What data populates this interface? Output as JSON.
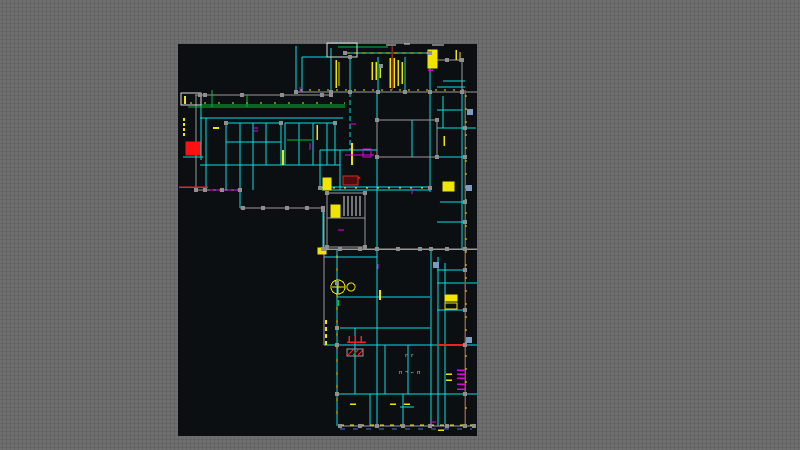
{
  "canvas": {
    "left": 178,
    "top": 44,
    "width": 299,
    "height": 392,
    "background": "#0c0f12"
  },
  "workspace": {
    "background": "#6e6e6e"
  },
  "palette": {
    "c": "#00e0e0",
    "y": "#f0e400",
    "m": "#e000e0",
    "g": "#00bb33",
    "r": "#ee2222",
    "R": "#ff1111",
    "w": "#d8d8d8",
    "gr": "#9a9a9a",
    "br": "#8a5a40",
    "bl": "#4a6cdc",
    "mr": "#802828",
    "hr": "#4a0e0e",
    "sq": "#8f8f8f",
    "bs": "#7e9cc2"
  },
  "drawing": {
    "lines": [
      [
        "c",
        345,
        53,
        430,
        53
      ],
      [
        "c",
        331,
        48,
        331,
        92
      ],
      [
        "c",
        296,
        46,
        296,
        92
      ],
      [
        "c",
        302,
        57,
        302,
        92
      ],
      [
        "c",
        302,
        57,
        331,
        57
      ],
      [
        "c",
        350,
        57,
        350,
        92
      ],
      [
        "c",
        378,
        57,
        378,
        92
      ],
      [
        "c",
        405,
        57,
        405,
        92
      ],
      [
        "c",
        430,
        53,
        430,
        92
      ],
      [
        "c",
        443,
        81,
        465,
        81
      ],
      [
        "c",
        437,
        87,
        465,
        87
      ],
      [
        "c",
        437,
        110,
        462,
        110
      ],
      [
        "c",
        443,
        96,
        443,
        128
      ],
      [
        "c",
        437,
        128,
        476,
        128
      ],
      [
        "c",
        377,
        157,
        465,
        157
      ],
      [
        "c",
        462,
        92,
        462,
        250
      ],
      [
        "c",
        377,
        92,
        377,
        250
      ],
      [
        "c",
        430,
        92,
        430,
        192
      ],
      [
        "c",
        412,
        120,
        412,
        157
      ],
      [
        "c",
        440,
        202,
        465,
        202
      ],
      [
        "c",
        437,
        222,
        465,
        222
      ],
      [
        "c",
        320,
        187,
        430,
        187
      ],
      [
        "c",
        322,
        190,
        430,
        190
      ],
      [
        "c",
        320,
        150,
        320,
        190
      ],
      [
        "c",
        320,
        150,
        377,
        150
      ],
      [
        "c",
        340,
        150,
        340,
        190
      ],
      [
        "c",
        350,
        92,
        350,
        150,
        1,
        "5 3"
      ],
      [
        "c",
        201,
        95,
        201,
        160
      ],
      [
        "c",
        200,
        118,
        343,
        118
      ],
      [
        "c",
        240,
        123,
        240,
        165
      ],
      [
        "c",
        253,
        123,
        253,
        165
      ],
      [
        "c",
        266,
        123,
        266,
        165
      ],
      [
        "c",
        226,
        142,
        281,
        142
      ],
      [
        "c",
        299,
        123,
        299,
        165
      ],
      [
        "c",
        313,
        123,
        313,
        165
      ],
      [
        "c",
        327,
        123,
        327,
        165
      ],
      [
        "c",
        200,
        165,
        340,
        165
      ],
      [
        "c",
        226,
        165,
        226,
        190
      ],
      [
        "c",
        240,
        165,
        240,
        190
      ],
      [
        "c",
        253,
        165,
        253,
        190
      ],
      [
        "c",
        206,
        118,
        206,
        190
      ],
      [
        "c",
        240,
        190,
        240,
        208
      ],
      [
        "c",
        323,
        210,
        323,
        250
      ],
      [
        "c",
        337,
        250,
        337,
        426
      ],
      [
        "c",
        377,
        250,
        377,
        426
      ],
      [
        "c",
        431,
        249,
        431,
        426
      ],
      [
        "c",
        438,
        257,
        438,
        426
      ],
      [
        "c",
        445,
        263,
        445,
        424
      ],
      [
        "c",
        324,
        257,
        377,
        257
      ],
      [
        "c",
        337,
        297,
        430,
        297
      ],
      [
        "c",
        437,
        270,
        465,
        270
      ],
      [
        "c",
        437,
        283,
        477,
        283
      ],
      [
        "c",
        437,
        310,
        465,
        310
      ],
      [
        "c",
        340,
        328,
        430,
        328
      ],
      [
        "c",
        324,
        345,
        477,
        345
      ],
      [
        "c",
        355,
        328,
        355,
        394
      ],
      [
        "c",
        385,
        345,
        385,
        394
      ],
      [
        "c",
        408,
        345,
        408,
        394
      ],
      [
        "c",
        337,
        394,
        477,
        394
      ],
      [
        "c",
        370,
        394,
        370,
        426
      ],
      [
        "c",
        403,
        394,
        403,
        426
      ],
      [
        "c",
        183,
        157,
        203,
        157
      ],
      [
        "c",
        400,
        407,
        414,
        407
      ],
      [
        "gr",
        296,
        92,
        477,
        92,
        1.2
      ],
      [
        "gr",
        195,
        95,
        331,
        95,
        1.2
      ],
      [
        "gr",
        196,
        95,
        196,
        190
      ],
      [
        "gr",
        195,
        190,
        240,
        190,
        1.2
      ],
      [
        "gr",
        240,
        208,
        323,
        208,
        1.2
      ],
      [
        "gr",
        324,
        210,
        324,
        345
      ],
      [
        "gr",
        324,
        249,
        477,
        249,
        1.5
      ],
      [
        "gr",
        340,
        426,
        475,
        426,
        1.2
      ],
      [
        "gr",
        327,
        218,
        365,
        218
      ],
      [
        "gr",
        437,
        60,
        462,
        60
      ],
      [
        "gr",
        462,
        60,
        462,
        92
      ],
      [
        "br",
        465,
        90,
        465,
        424,
        1.5
      ],
      [
        "w",
        344,
        196,
        344,
        216
      ],
      [
        "w",
        348,
        196,
        348,
        216
      ],
      [
        "w",
        352,
        196,
        352,
        216
      ],
      [
        "w",
        356,
        196,
        356,
        216
      ],
      [
        "w",
        360,
        196,
        360,
        216
      ],
      [
        "w",
        386,
        45,
        396,
        45
      ],
      [
        "w",
        432,
        45,
        444,
        45
      ],
      [
        "w",
        404,
        44,
        410,
        44
      ],
      [
        "y",
        390,
        58,
        390,
        88,
        1.5
      ],
      [
        "y",
        394,
        58,
        394,
        88,
        1.5
      ],
      [
        "y",
        398,
        60,
        398,
        86,
        1.5
      ],
      [
        "y",
        402,
        62,
        402,
        84,
        1.5
      ],
      [
        "y",
        372,
        62,
        372,
        80,
        1.5
      ],
      [
        "y",
        376,
        62,
        376,
        80,
        1.5
      ],
      [
        "y",
        380,
        64,
        380,
        78,
        1.5
      ],
      [
        "y",
        336,
        60,
        336,
        88,
        1.5
      ],
      [
        "y",
        339,
        62,
        339,
        86,
        1
      ],
      [
        "y",
        352,
        143,
        352,
        165,
        2
      ],
      [
        "y",
        283,
        150,
        283,
        165,
        2
      ],
      [
        "y",
        317,
        125,
        317,
        140,
        1.5
      ],
      [
        "y",
        184,
        118,
        184,
        136,
        2,
        "3 2"
      ],
      [
        "y",
        185,
        96,
        185,
        104,
        2
      ],
      [
        "y",
        213,
        128,
        219,
        128,
        2
      ],
      [
        "y",
        380,
        290,
        380,
        300,
        2
      ],
      [
        "y",
        456,
        50,
        456,
        60,
        1.5
      ],
      [
        "y",
        460,
        52,
        460,
        62,
        1
      ],
      [
        "y",
        444,
        136,
        444,
        146,
        1.5
      ],
      [
        "y",
        326,
        320,
        326,
        348,
        2,
        "4 3"
      ],
      [
        "y",
        350,
        404,
        356,
        404,
        1.5
      ],
      [
        "y",
        404,
        404,
        410,
        404,
        1.5
      ],
      [
        "y",
        390,
        404,
        396,
        404,
        1.5
      ],
      [
        "y",
        446,
        374,
        452,
        374,
        1.5
      ],
      [
        "y",
        446,
        380,
        452,
        380,
        1.5
      ],
      [
        "y",
        438,
        430,
        444,
        430,
        1.5
      ],
      [
        "y",
        346,
        53,
        430,
        53,
        1,
        "4 4"
      ],
      [
        "y",
        300,
        90,
        465,
        90,
        1,
        "2 7"
      ],
      [
        "y",
        322,
        188,
        430,
        188,
        1,
        "2 9"
      ],
      [
        "y",
        337,
        255,
        337,
        424,
        1,
        "3 10"
      ],
      [
        "y",
        466,
        95,
        466,
        420,
        1,
        "2 11"
      ],
      [
        "y",
        340,
        425,
        475,
        425,
        1,
        "4 6"
      ],
      [
        "y",
        190,
        103,
        345,
        103,
        1,
        "2 12"
      ],
      [
        "m",
        204,
        190,
        240,
        190,
        1,
        "3 3"
      ],
      [
        "m",
        345,
        155,
        374,
        155
      ],
      [
        "m",
        457,
        370,
        465,
        370,
        1.5
      ],
      [
        "m",
        457,
        374,
        465,
        374,
        1.5
      ],
      [
        "m",
        457,
        378,
        465,
        378,
        1.5
      ],
      [
        "m",
        457,
        384,
        465,
        384,
        1.5
      ],
      [
        "m",
        457,
        389,
        465,
        389,
        1.5
      ],
      [
        "m",
        412,
        188,
        412,
        194
      ],
      [
        "m",
        350,
        124,
        356,
        124
      ],
      [
        "m",
        253,
        128,
        258,
        128
      ],
      [
        "m",
        253,
        131,
        258,
        131
      ],
      [
        "m",
        338,
        230,
        344,
        230
      ],
      [
        "m",
        300,
        87,
        300,
        93
      ],
      [
        "m",
        430,
        422,
        436,
        422
      ],
      [
        "m",
        378,
        264,
        378,
        269
      ],
      [
        "m",
        310,
        143,
        310,
        150
      ],
      [
        "m",
        428,
        70,
        433,
        70,
        1.5
      ],
      [
        "g",
        188,
        105,
        345,
        105
      ],
      [
        "g",
        188,
        107,
        345,
        107
      ],
      [
        "g",
        212,
        90,
        212,
        107
      ],
      [
        "g",
        247,
        95,
        247,
        107
      ],
      [
        "g",
        338,
        47,
        388,
        47
      ],
      [
        "g",
        287,
        140,
        312,
        140
      ],
      [
        "g",
        338,
        300,
        338,
        306,
        2
      ],
      [
        "r",
        179,
        187,
        208,
        187,
        1.5
      ],
      [
        "r",
        347,
        342,
        366,
        342,
        1.5
      ],
      [
        "r",
        349,
        336,
        349,
        342,
        1.5
      ],
      [
        "r",
        355,
        336,
        355,
        342,
        1.5
      ],
      [
        "r",
        361,
        336,
        361,
        342,
        1.5
      ],
      [
        "r",
        437,
        345,
        465,
        345,
        2
      ],
      [
        "mr",
        392,
        46,
        392,
        90,
        1.5
      ],
      [
        "r",
        344,
        184,
        350,
        177
      ],
      [
        "r",
        349,
        184,
        355,
        177
      ],
      [
        "r",
        354,
        184,
        360,
        177
      ],
      [
        "r",
        348,
        355,
        353,
        350
      ],
      [
        "r",
        353,
        355,
        358,
        350
      ],
      [
        "r",
        358,
        355,
        363,
        350
      ],
      [
        "bl",
        340,
        429,
        472,
        429,
        1,
        "5 8"
      ],
      [
        "y",
        332,
        287,
        345,
        287
      ],
      [
        "y",
        338,
        281,
        338,
        294
      ]
    ],
    "rects": [
      [
        "gr",
        377,
        120,
        60,
        37,
        null
      ],
      [
        "c",
        226,
        123,
        55,
        42,
        null
      ],
      [
        "c",
        285,
        123,
        50,
        42,
        null
      ],
      [
        "gr",
        327,
        193,
        38,
        54,
        null
      ],
      [
        "w",
        181,
        93,
        20,
        12,
        null
      ],
      [
        "w",
        327,
        43,
        30,
        14,
        null
      ],
      [
        "R",
        186,
        142,
        14,
        13,
        "R"
      ],
      [
        "r",
        343,
        176,
        15,
        9,
        "hr"
      ],
      [
        "gr",
        347,
        349,
        16,
        7,
        null
      ],
      [
        "y",
        323,
        178,
        8,
        12,
        "y"
      ],
      [
        "y",
        331,
        205,
        9,
        12,
        "y"
      ],
      [
        "y",
        443,
        182,
        11,
        9,
        "y"
      ],
      [
        "y",
        445,
        295,
        12,
        6,
        "y"
      ],
      [
        "y",
        445,
        303,
        12,
        6,
        null
      ],
      [
        "m",
        363,
        149,
        8,
        8,
        null
      ],
      [
        "y",
        428,
        50,
        9,
        18,
        "y"
      ],
      [
        "y",
        318,
        248,
        8,
        6,
        "y"
      ]
    ],
    "squares": [
      [
        345,
        53
      ],
      [
        430,
        53
      ],
      [
        350,
        57
      ],
      [
        381,
        66
      ],
      [
        447,
        60
      ],
      [
        462,
        60
      ],
      [
        296,
        92
      ],
      [
        331,
        92
      ],
      [
        350,
        92
      ],
      [
        378,
        92
      ],
      [
        405,
        92
      ],
      [
        430,
        92
      ],
      [
        462,
        92
      ],
      [
        377,
        120
      ],
      [
        437,
        120
      ],
      [
        377,
        157
      ],
      [
        437,
        157
      ],
      [
        200,
        95
      ],
      [
        205,
        95
      ],
      [
        242,
        95
      ],
      [
        282,
        95
      ],
      [
        322,
        95
      ],
      [
        331,
        95
      ],
      [
        196,
        190
      ],
      [
        205,
        190
      ],
      [
        222,
        190
      ],
      [
        240,
        190
      ],
      [
        243,
        208
      ],
      [
        263,
        208
      ],
      [
        287,
        208
      ],
      [
        307,
        208
      ],
      [
        323,
        208
      ],
      [
        323,
        210
      ],
      [
        323,
        249
      ],
      [
        324,
        249
      ],
      [
        340,
        249
      ],
      [
        360,
        249
      ],
      [
        377,
        249
      ],
      [
        398,
        249
      ],
      [
        420,
        249
      ],
      [
        431,
        249
      ],
      [
        447,
        249
      ],
      [
        465,
        249
      ],
      [
        320,
        188
      ],
      [
        430,
        188
      ],
      [
        340,
        426
      ],
      [
        360,
        426
      ],
      [
        377,
        426
      ],
      [
        403,
        426
      ],
      [
        430,
        426
      ],
      [
        447,
        426
      ],
      [
        465,
        426
      ],
      [
        474,
        426
      ],
      [
        465,
        128
      ],
      [
        465,
        157
      ],
      [
        465,
        202
      ],
      [
        465,
        222
      ],
      [
        465,
        270
      ],
      [
        465,
        310
      ],
      [
        465,
        345
      ],
      [
        465,
        394
      ],
      [
        337,
        283
      ],
      [
        337,
        328
      ],
      [
        337,
        345
      ],
      [
        337,
        394
      ],
      [
        327,
        193
      ],
      [
        365,
        193
      ],
      [
        327,
        247
      ],
      [
        365,
        247
      ],
      [
        226,
        123
      ],
      [
        281,
        123
      ],
      [
        335,
        123
      ]
    ],
    "blue_squares": [
      [
        470,
        112
      ],
      [
        469,
        188
      ],
      [
        436,
        265
      ],
      [
        469,
        340
      ]
    ],
    "circles": [
      [
        338,
        287,
        7,
        "y"
      ],
      [
        351,
        287,
        4,
        "y"
      ]
    ],
    "texts": [
      [
        405,
        357,
        "г г",
        5
      ],
      [
        399,
        374,
        "п ¬ ⌐ п",
        5
      ]
    ]
  }
}
